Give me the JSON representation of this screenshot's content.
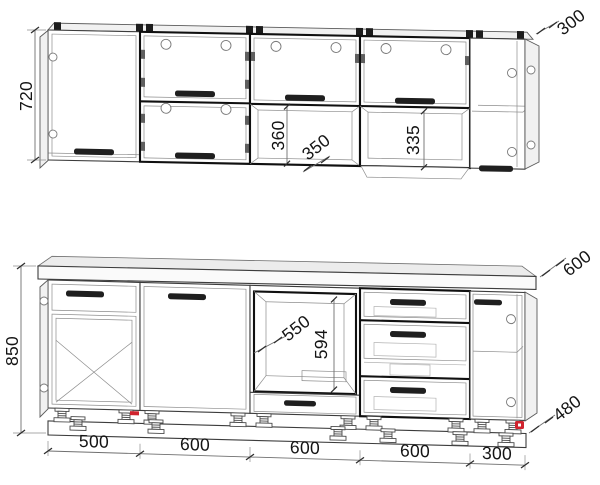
{
  "dimensions": {
    "wall_row": {
      "height": "720",
      "end_depth": "300",
      "niche_height": "360",
      "niche_leader": "350",
      "flap_niche_height": "335"
    },
    "base_row": {
      "height": "850",
      "worktop_depth": "600",
      "oven_niche_leader": "550",
      "oven_niche_height": "594",
      "plinth_leader": "480",
      "widths": [
        "500",
        "600",
        "600",
        "600",
        "300"
      ]
    },
    "colors": {
      "line": "#3c3c3c",
      "accent_red": "#d0232e"
    }
  }
}
